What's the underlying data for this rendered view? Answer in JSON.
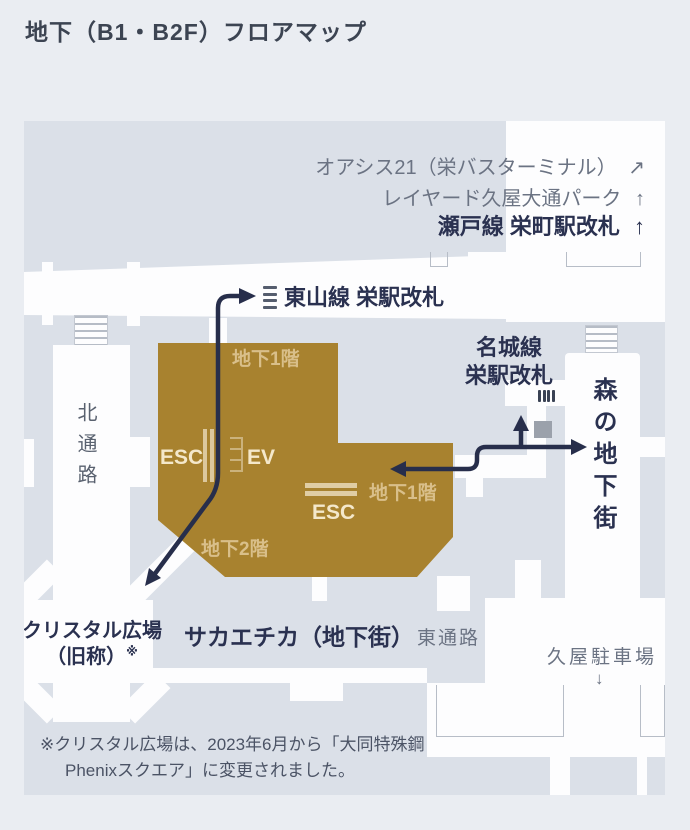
{
  "page": {
    "title": "地下（B1・B2F）フロアマップ"
  },
  "map": {
    "destinations": {
      "oasis21": "オアシス21（栄バスターミナル）",
      "oasis21_arrow": "↗",
      "layered_park": "レイヤード久屋大通パーク",
      "layered_park_arrow": "↑",
      "setosen": "瀬戸線 栄町駅改札",
      "setosen_arrow": "↑",
      "higashiyama": "東山線 栄駅改札",
      "meijo_line1": "名城線",
      "meijo_line2": "栄駅改札",
      "mori_chikagai": "森の地下街",
      "kita_tsuro": "北通路",
      "crystal_line1": "クリスタル広場",
      "crystal_line2": "（旧称）",
      "crystal_note_mark": "※",
      "sakaechika": "サカエチカ（地下街）",
      "higashi_tsuro": "東通路",
      "hisaya_parking": "久屋駐車場",
      "hisaya_parking_arrow": "↓"
    },
    "building": {
      "b1_label_top": "地下1階",
      "b1_label_right": "地下1階",
      "b2_label": "地下2階",
      "esc_left": "ESC",
      "esc_right": "ESC",
      "ev": "EV"
    },
    "note": {
      "line1": "※クリスタル広場は、2023年6月から「大同特殊鋼",
      "line2": "Phenixスクエア」に変更されました。"
    },
    "icons": [
      "ticket-gate-horizontal-icon",
      "ticket-gate-vertical-icon",
      "escalator-icon",
      "elevator-icon",
      "stairs-icon"
    ],
    "colors": {
      "page_background": "#eaedf2",
      "map_background": "#dbe0e8",
      "corridor_white": "#fdfdfe",
      "building_brown": "#a8822f",
      "floor_label_tan": "#d9bf8a",
      "route_navy": "#272e4b",
      "heading_navy": "#2a3150",
      "gray_text": "#6b7383",
      "gray_block": "#9ba1ab"
    }
  }
}
